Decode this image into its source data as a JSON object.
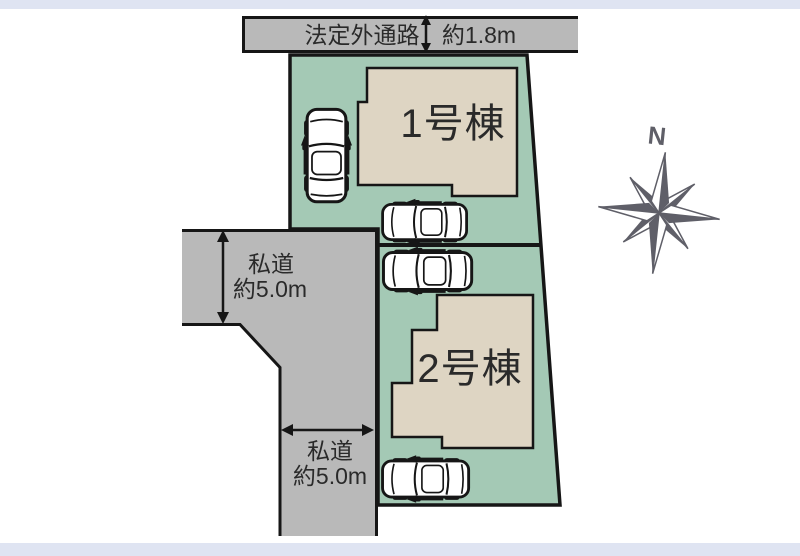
{
  "site_plan": {
    "buildings": [
      {
        "label": "1号棟"
      },
      {
        "label": "2号棟"
      }
    ],
    "roads": {
      "legal_outside_path": {
        "label": "法定外通路",
        "width_label": "約1.8m"
      },
      "private_road_upper": {
        "label": "私道",
        "width_label": "約5.0m"
      },
      "private_road_lower": {
        "label": "私道",
        "width_label": "約5.0m"
      }
    },
    "compass": {
      "north_label": "N"
    },
    "cars_count": 4,
    "colors": {
      "parcel_green": "#a4c9b5",
      "building_beige": "#ded5c3",
      "road_gray": "#b9b9b9",
      "outline_black": "#161616",
      "compass_gray": "#5f5f68",
      "page_strip_blue": "#dfe4f2"
    }
  }
}
